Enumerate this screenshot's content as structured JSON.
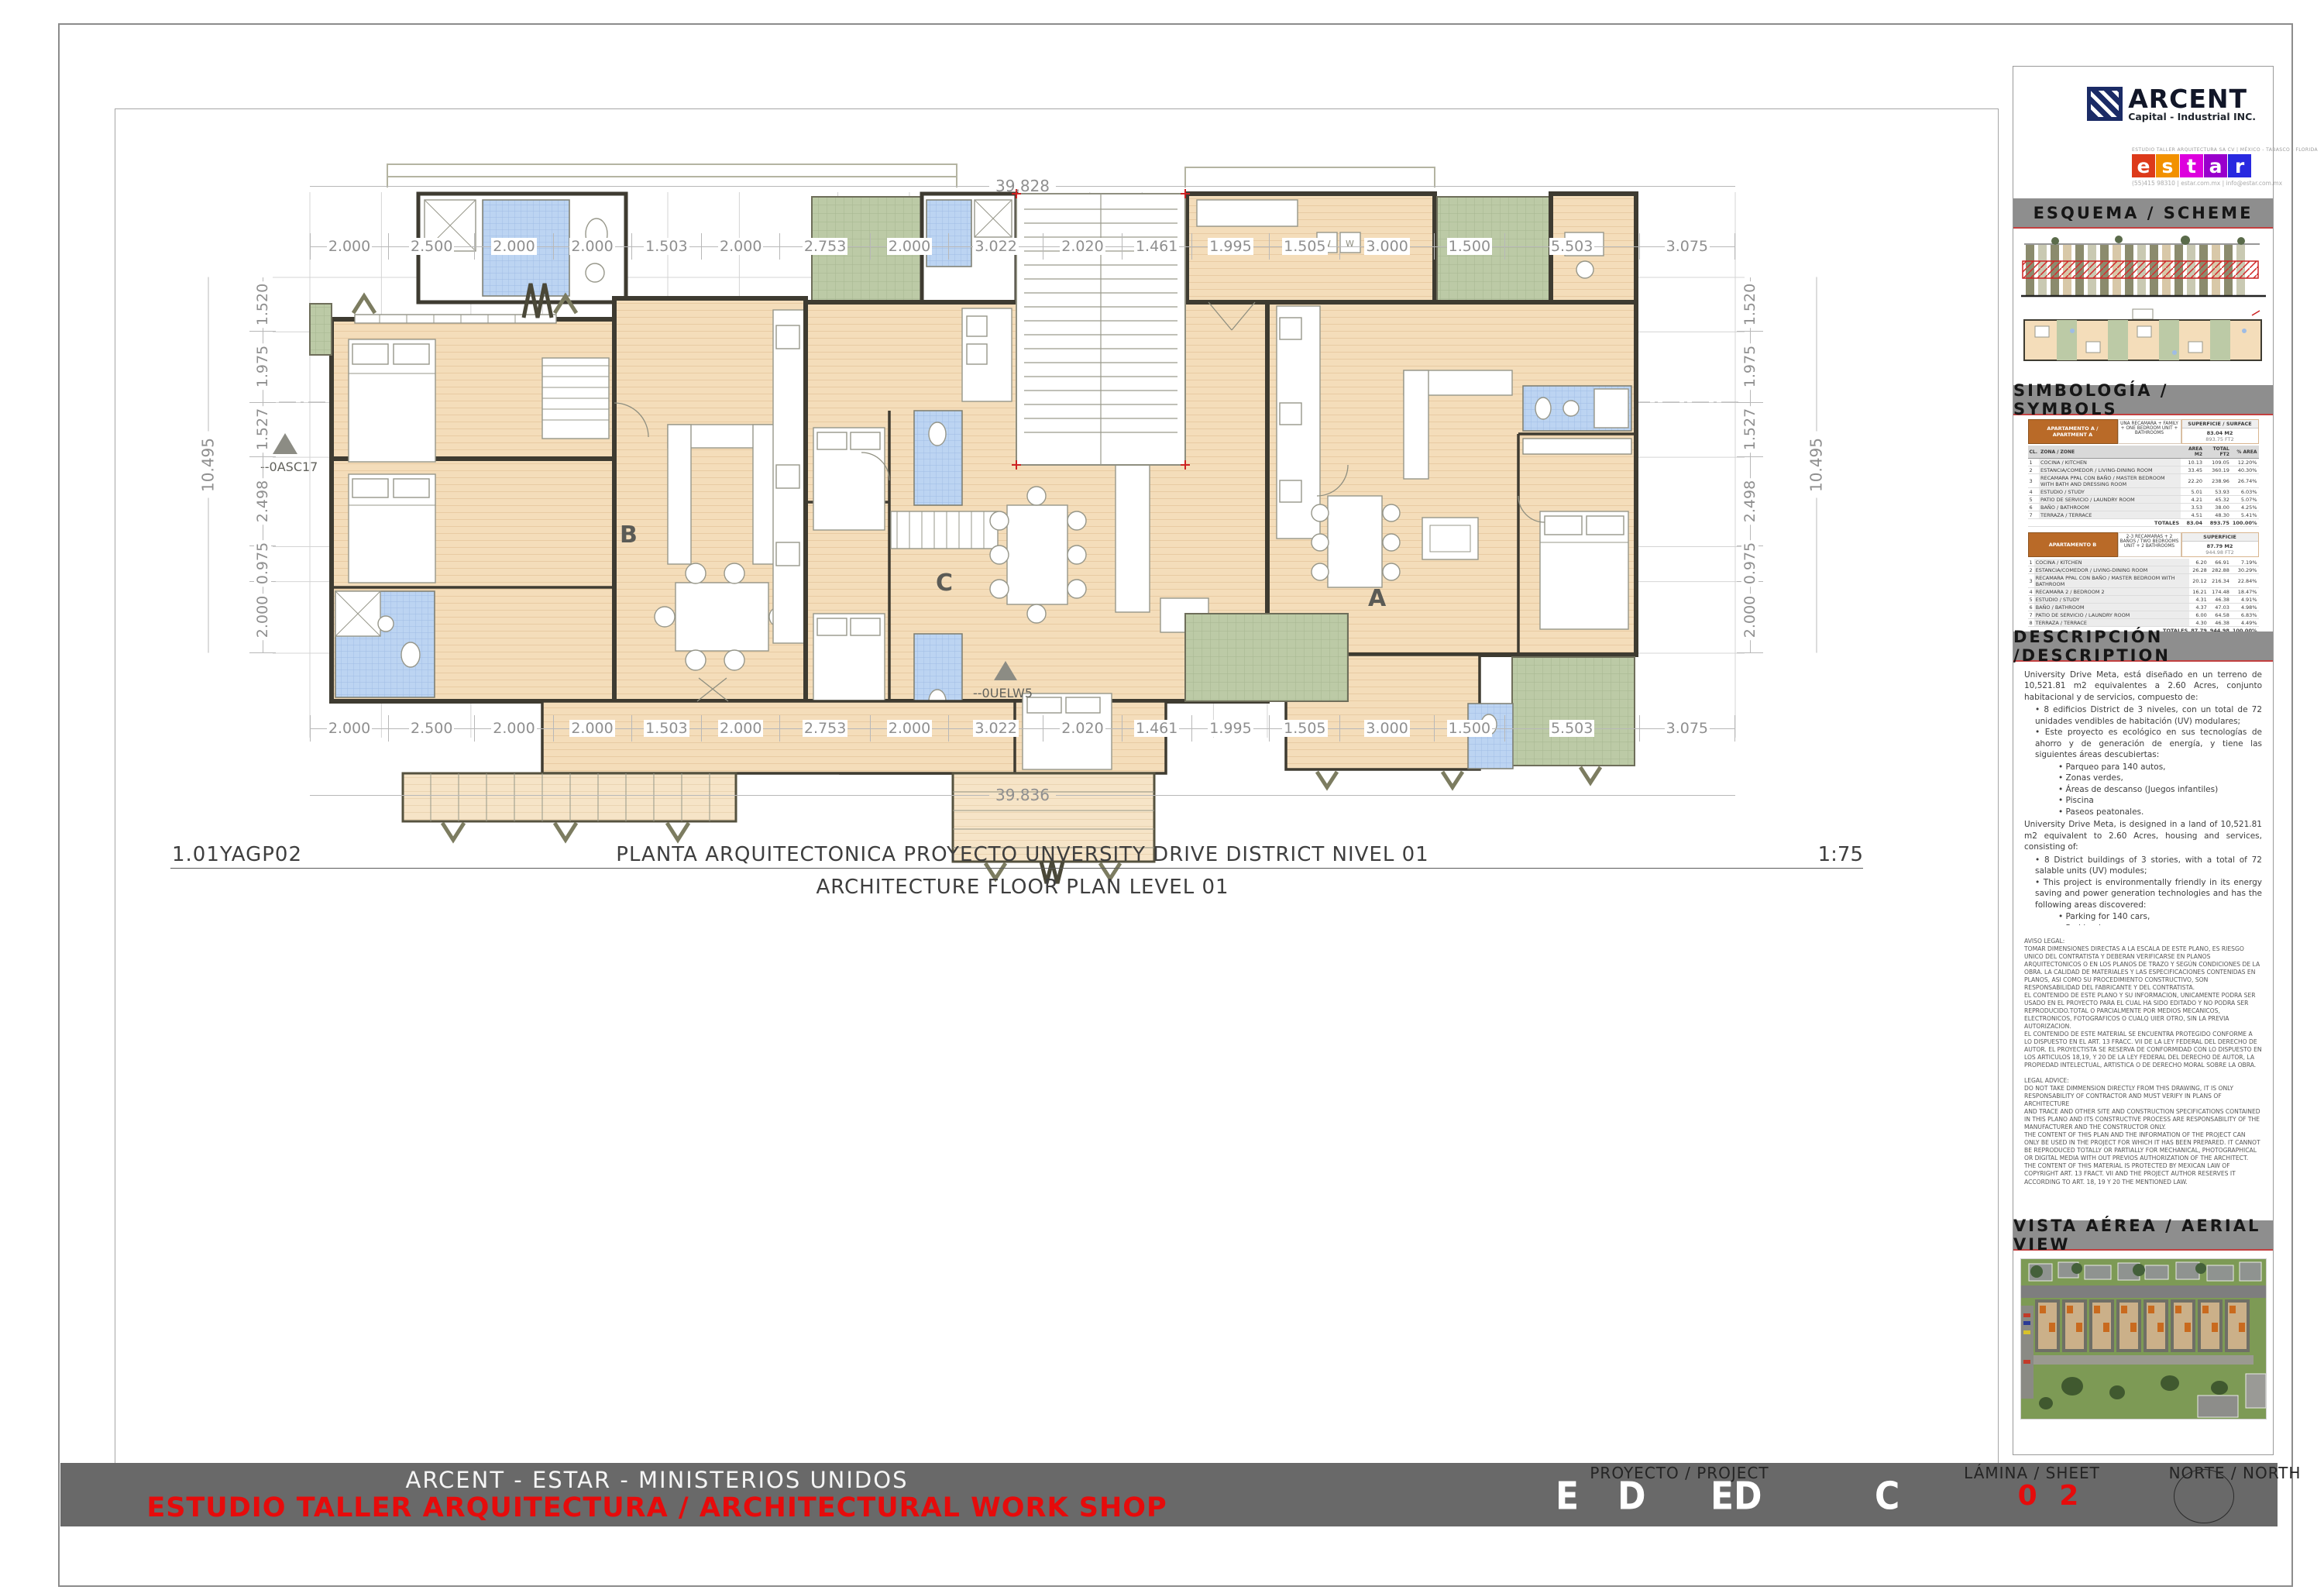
{
  "sheet": {
    "drawing_code": "1.01YAGP02",
    "title_es": "PLANTA ARQUITECTONICA PROYECTO UNVERSITY DRIVE DISTRICT NIVEL 01",
    "title_en": "ARCHITECTURE FLOOR PLAN LEVEL 01",
    "scale": "1:75"
  },
  "plan": {
    "unit_labels": {
      "a": "A",
      "b": "B",
      "c": "C"
    },
    "markers": {
      "left": "--0ASC17",
      "center": "--0UELW5"
    },
    "dims_top": [
      "2.000",
      "2.500",
      "2.000",
      "2.000",
      "1.503",
      "2.000",
      "2.753",
      "2.000",
      "3.022",
      "2.020",
      "1.461",
      "1.995",
      "1.505",
      "3.000",
      "1.500",
      "5.503",
      "3.075"
    ],
    "dims_bottom": [
      "2.000",
      "2.500",
      "2.000",
      "2.000",
      "1.503",
      "2.000",
      "2.753",
      "2.000",
      "3.022",
      "2.020",
      "1.461",
      "1.995",
      "1.505",
      "3.000",
      "1.500",
      "5.503",
      "3.075"
    ],
    "total_top": "39.828",
    "total_bottom": "39.836",
    "dims_left": [
      "1.520",
      "1.975",
      "1.527",
      "2.498",
      "0.975",
      "2.000"
    ],
    "dims_right": [
      "1.520",
      "1.975",
      "1.527",
      "2.498",
      "0.975",
      "2.000"
    ],
    "total_left": "10.495",
    "total_right": "10.495"
  },
  "titleblock": {
    "arcent": {
      "name": "ARCENT",
      "tagline": "Capital - Industrial INC."
    },
    "estar": {
      "firm_line": "ESTUDIO TALLER ARQUITECTURA SA CV | MÉXICO  -  TABASCO  -  FLORIDA",
      "letters": [
        "e",
        "s",
        "t",
        "a",
        "r"
      ],
      "tile_colors": [
        "#dd3a1a",
        "#f29100",
        "#dd00dd",
        "#9900cc",
        "#2929e0"
      ],
      "contact": "(55)415 98310   |   estar.com.mx   |   info@estar.com.mx"
    },
    "sections": {
      "scheme": "ESQUEMA / SCHEME",
      "symbols": "SIMBOLOGÍA / SYMBOLS",
      "description": "DESCRIPCIÓN /DESCRIPTION",
      "aerial": "VISTA AÉREA / AERIAL VIEW"
    },
    "symbols": {
      "col_headers": {
        "cl": "CL.",
        "zone": "ZONA / ZONE",
        "m2": "AREA M2",
        "ft2": "TOTAL FT2",
        "pct": "% AREA"
      },
      "tables": [
        {
          "title": "APARTAMENTO A / APARTMENT A",
          "note": "UNA RECAMARA + FAMILY + ONE BEDROOM UNIT + BATHROOMS",
          "sup_label": "SUPERFICIE / SURFACE",
          "sup_m2": "83.04 M2",
          "sup_ft2": "893.75 FT2",
          "rows": [
            {
              "n": "1",
              "zone": "COCINA / KITCHEN",
              "m2": "10.13",
              "ft2": "109.05",
              "pct": "12.20%"
            },
            {
              "n": "2",
              "zone": "ESTANCIA/COMEDOR / LIVING-DINING ROOM",
              "m2": "33.45",
              "ft2": "360.19",
              "pct": "40.30%"
            },
            {
              "n": "3",
              "zone": "RECAMARA PPAL CON BAÑO / MASTER BEDROOM WITH BATH AND DRESSING ROOM",
              "m2": "22.20",
              "ft2": "238.96",
              "pct": "26.74%"
            },
            {
              "n": "4",
              "zone": "ESTUDIO / STUDY",
              "m2": "5.01",
              "ft2": "53.93",
              "pct": "6.03%"
            },
            {
              "n": "5",
              "zone": "PATIO DE SERVICIO / LAUNDRY ROOM",
              "m2": "4.21",
              "ft2": "45.32",
              "pct": "5.07%"
            },
            {
              "n": "6",
              "zone": "BAÑO / BATHROOM",
              "m2": "3.53",
              "ft2": "38.00",
              "pct": "4.25%"
            },
            {
              "n": "7",
              "zone": "TERRAZA / TERRACE",
              "m2": "4.51",
              "ft2": "48.30",
              "pct": "5.41%"
            }
          ],
          "totals": {
            "label": "TOTALES",
            "m2": "83.04",
            "ft2": "893.75",
            "pct": "100.00%"
          }
        },
        {
          "title": "APARTAMENTO B",
          "note": "2-3 RECAMARAS + 2 BAÑOS / TWO BEDROOMS UNIT + 2 BATHROOMS",
          "sup_label": "SUPERFICIE",
          "sup_m2": "87.79 M2",
          "sup_ft2": "944.98 FT2",
          "rows": [
            {
              "n": "1",
              "zone": "COCINA / KITCHEN",
              "m2": "6.20",
              "ft2": "66.91",
              "pct": "7.19%"
            },
            {
              "n": "2",
              "zone": "ESTANCIA/COMEDOR / LIVING-DINING ROOM",
              "m2": "26.28",
              "ft2": "282.88",
              "pct": "30.29%"
            },
            {
              "n": "3",
              "zone": "RECAMARA PPAL CON BAÑO / MASTER BEDROOM WITH BATHROOM",
              "m2": "20.12",
              "ft2": "216.34",
              "pct": "22.84%"
            },
            {
              "n": "4",
              "zone": "RECAMARA 2 / BEDROOM 2",
              "m2": "16.21",
              "ft2": "174.48",
              "pct": "18.47%"
            },
            {
              "n": "5",
              "zone": "ESTUDIO / STUDY",
              "m2": "4.31",
              "ft2": "46.38",
              "pct": "4.91%"
            },
            {
              "n": "6",
              "zone": "BAÑO / BATHROOM",
              "m2": "4.37",
              "ft2": "47.03",
              "pct": "4.98%"
            },
            {
              "n": "7",
              "zone": "PATIO DE SERVICIO / LAUNDRY ROOM",
              "m2": "6.00",
              "ft2": "64.58",
              "pct": "6.83%"
            },
            {
              "n": "8",
              "zone": "TERRAZA / TERRACE",
              "m2": "4.30",
              "ft2": "46.38",
              "pct": "4.49%"
            }
          ],
          "totals": {
            "label": "TOTALES",
            "m2": "87.79",
            "ft2": "944.98",
            "pct": "100.00%"
          }
        },
        {
          "title": "APARTAMENTO C",
          "note": "TRES RECAMARAS + 2 BAÑOS / THREE BEDROOMS UNIT + 2 BATHROOMS",
          "sup_label": "SUPERFICIE",
          "sup_m2": "101.24 M2",
          "sup_ft2": "1,089.72 FT2",
          "rows": [
            {
              "n": "1",
              "zone": "RECAMARA PPAL CON BAÑO / MASTER BEDROOM WITH BATHROOM",
              "m2": "24.33",
              "ft2": "261.76",
              "pct": "24.03%"
            },
            {
              "n": "2",
              "zone": "RECAMARA 2 / BEDROOM 2",
              "m2": "9.12",
              "ft2": "98.15",
              "pct": "9.01%"
            },
            {
              "n": "3",
              "zone": "RECAMARA 3 / BEDROOM 3",
              "m2": "9.12",
              "ft2": "98.15",
              "pct": "9.01%"
            },
            {
              "n": "4",
              "zone": "BAÑO / BATHROOM",
              "m2": "4.54",
              "ft2": "48.87",
              "pct": "4.48%"
            },
            {
              "n": "5",
              "zone": "ESTANCIA/COMEDOR / LIVING-DINING ROOM",
              "m2": "35.21",
              "ft2": "379.01",
              "pct": "34.78%"
            },
            {
              "n": "6",
              "zone": "COCINA / KITCHEN",
              "m2": "8.10",
              "ft2": "87.19",
              "pct": "8.00%"
            },
            {
              "n": "7",
              "zone": "PATIO DE SERVICIO / LAUNDRY ROOM",
              "m2": "5.21",
              "ft2": "56.08",
              "pct": "5.15%"
            },
            {
              "n": "8",
              "zone": "TERRAZA / TERRACE",
              "m2": "5.61",
              "ft2": "60.51",
              "pct": "5.54%"
            }
          ],
          "totals": {
            "label": "TOTALES",
            "m2": "101.24",
            "ft2": "1,089.72",
            "pct": "100.00%"
          }
        }
      ]
    },
    "description": {
      "es": {
        "intro": "University Drive Meta, está diseñado en un terreno de 10,521.81 m2 equivalentes a 2.60 Acres, conjunto habitacional y de servicios, compuesto de:",
        "bullets": [
          "8 edificios District de 3 niveles, con un total de 72 unidades vendibles de habitación (UV) modulares;",
          "Este proyecto es ecológico en sus tecnologías de ahorro y de generación de energía, y tiene las siguientes áreas descubiertas:"
        ],
        "sub_bullets": [
          "Parqueo para 140 autos,",
          "Zonas verdes,",
          "Áreas de descanso (Juegos infantiles)",
          "Piscina",
          "Paseos peatonales."
        ]
      },
      "en": {
        "intro": "University Drive Meta, is designed in a land of 10,521.81 m2 equivalent to 2.60 Acres, housing and services, consisting of:",
        "bullets": [
          "8 District buildings of 3 stories, with a total of 72 salable units (UV) modules;",
          "This project is environmentally friendly in its energy saving and power generation technologies and has the following areas discovered:"
        ],
        "sub_bullets": [
          "Parking for 140 cars,",
          "Parkland,",
          "Rest areas (Children's Games)",
          "Swimming pool,",
          "Pedestrian walks."
        ]
      }
    },
    "legal": {
      "es": "AVISO LEGAL:\nTOMAR DIMENSIONES DIRECTAS A LA ESCALA DE ESTE PLANO, ES RIESGO UNICO DEL CONTRATISTA Y DEBERAN VERIFICARSE EN PLANOS ARQUITECTONICOS O EN LOS PLANOS DE TRAZO Y SEGÚN CONDICIONES DE LA OBRA. LA CALIDAD DE MATERIALES Y LAS ESPECIFICACIONES CONTENIDAS EN PLANOS, ASI COMO SU PROCEDIMIENTO CONSTRUCTIVO, SON RESPONSABILIDAD DEL FABRICANTE Y DEL CONTRATISTA.\nEL CONTENIDO DE ESTE PLANO Y SU INFORMACION, UNICAMENTE PODRA SER USADO EN EL PROYECTO PARA EL CUAL HA SIDO EDITADO Y NO PODRA SER REPRODUCIDO.TOTAL O PARCIALMENTE POR MEDIOS MECANICOS, ELECTRONICOS, FOTOGRAFICOS O CUALQ UIER OTRO, SIN LA PREVIA AUTORIZACION.\nEL CONTENIDO DE ESTE MATERIAL SE ENCUENTRA PROTEGIDO CONFORME A LO DISPUESTO EN EL ART. 13 FRACC. VII DE LA LEY FEDERAL DEL DERECHO DE AUTOR. EL PROYECTISTA SE RESERVA DE CONFORMIDAD CON LO DISPUESTO EN LOS ARTICULOS 18,19, Y 20  DE LA LEY FEDERAL DEL DERECHO DE AUTOR, LA PROPIEDAD INTELECTUAL, ARTISTICA O DE DERECHO MORAL SOBRE LA OBRA.",
      "en": "LEGAL ADVICE:\nDO NOT TAKE DIMMENSION DIRECTLY FROM THIS DRAWING, IT IS ONLY RESPONSABILITY OF CONTRACTOR AND MUST VERIFY IN PLANS OF ARCHITECTURE\nAND TRACE AND OTHER SITE AND CONSTRUCTION SPECIFICATIONS CONTAINED IN THIS PLANO AND ITS CONSTRUCTIVE PROCESS ARE RESPONSABILITY OF THE MANUFACTURER AND THE CONSTRUCTOR ONLY.\nTHE CONTENT OF THIS PLAN AND THE INFORMATION OF THE PROJECT CAN ONLY BE USED IN THE PROJECT FOR WHICH IT HAS BEEN PREPARED. IT CANNOT BE REPRODUCED TOTALLY OR PARTIALLY FOR MECHANICAL, PHOTOGRAPHICAL OR DIGITAL MEDIA WITH OUT PREVIOS AUTHORIZATION OF THE ARCHITECT.\nTHE CONTENT OF THIS MATERIAL IS PROTECTED BY MEXICAN LAW OF COPYRIGHT ART. 13 FRACT. VII AND THE PROJECT AUTHOR RESERVES IT ACCORDING TO ART. 18, 19 Y 20 THE MENTIONED LAW."
    }
  },
  "footer": {
    "company_line": "ARCENT - ESTAR - MINISTERIOS UNIDOS",
    "studio_line": "ESTUDIO TALLER ARQUITECTURA  / ARCHITECTURAL WORK SHOP",
    "project_label": "PROYECTO / PROJECT",
    "project_letters": [
      "E",
      "D",
      "ED",
      "C"
    ],
    "sheet_label": "LÁMINA / SHEET",
    "sheet_number": "0 2",
    "north_label": "NORTE / NORTH"
  }
}
